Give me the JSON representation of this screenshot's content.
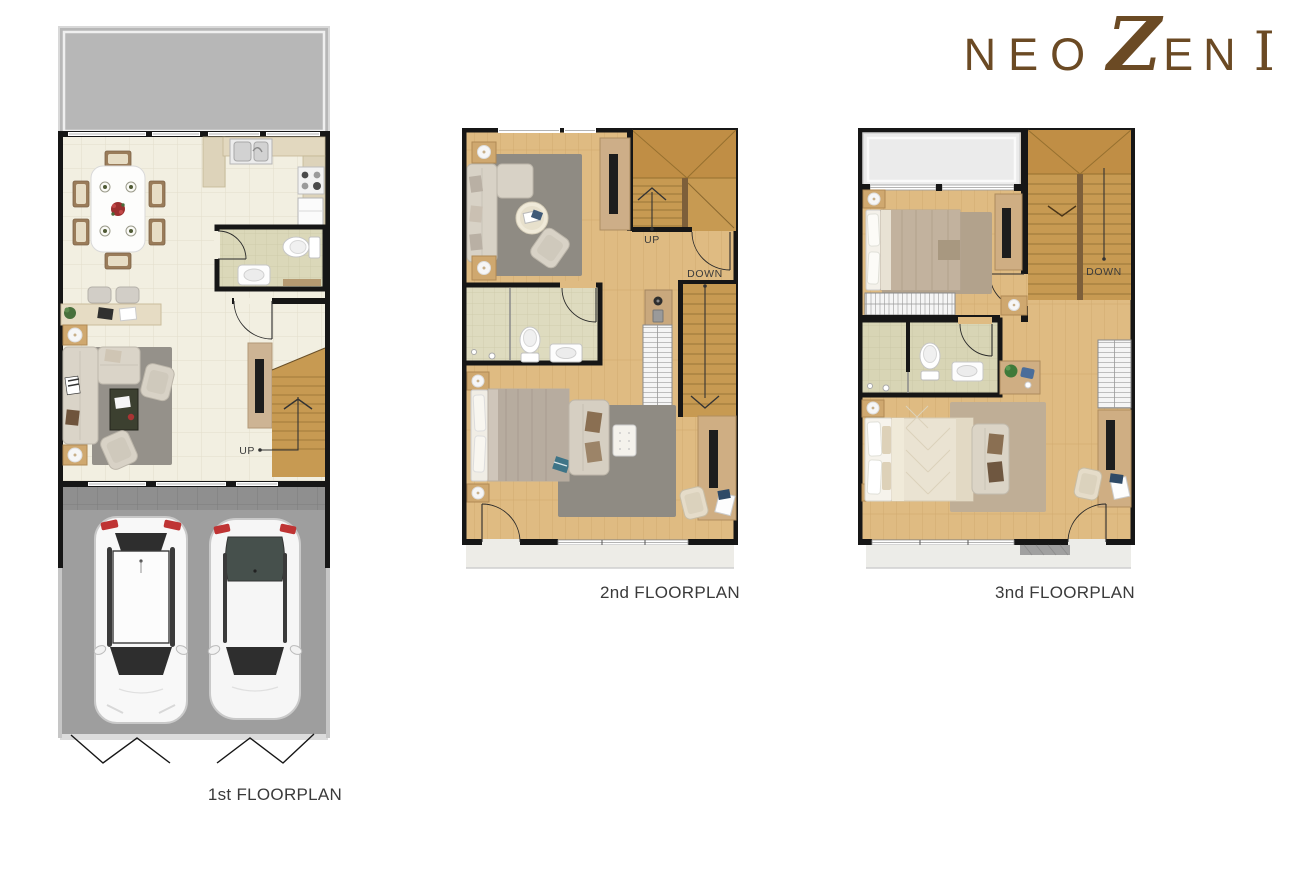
{
  "brand": {
    "name": "NEO ZEN I",
    "logo": {
      "word1": "NEO",
      "z": "Z",
      "en": "EN",
      "numeral": "I"
    },
    "color": "#6b4a24"
  },
  "floorplans": [
    {
      "id": "first",
      "label": "1st FLOORPLAN",
      "stairs": [
        "UP"
      ],
      "rooms": [
        "terrace",
        "dining",
        "kitchen",
        "bathroom",
        "living",
        "stairs",
        "garage"
      ]
    },
    {
      "id": "second",
      "label": "2nd FLOORPLAN",
      "stairs": [
        "UP",
        "DOWN"
      ],
      "rooms": [
        "family-area",
        "bathroom",
        "bedroom",
        "stairs",
        "balcony"
      ]
    },
    {
      "id": "third",
      "label": "3nd FLOORPLAN",
      "stairs": [
        "DOWN"
      ],
      "rooms": [
        "balcony",
        "bedroom-2",
        "stairs",
        "bathroom",
        "master-bedroom",
        "balcony-rear"
      ]
    }
  ],
  "palette": {
    "brand_brown": "#6b4a24",
    "wall": "#161616",
    "tile_floor": "#f2efe1",
    "wood_floor": "#dfbb82",
    "stair_wood": "#c79a52",
    "bath_tile": "#dbd8b9",
    "terrace_gray": "#b7b7b7",
    "garage_gray": "#9e9e9e",
    "rug_gray": "#8f8b83",
    "label_text": "#3a3a3a"
  }
}
